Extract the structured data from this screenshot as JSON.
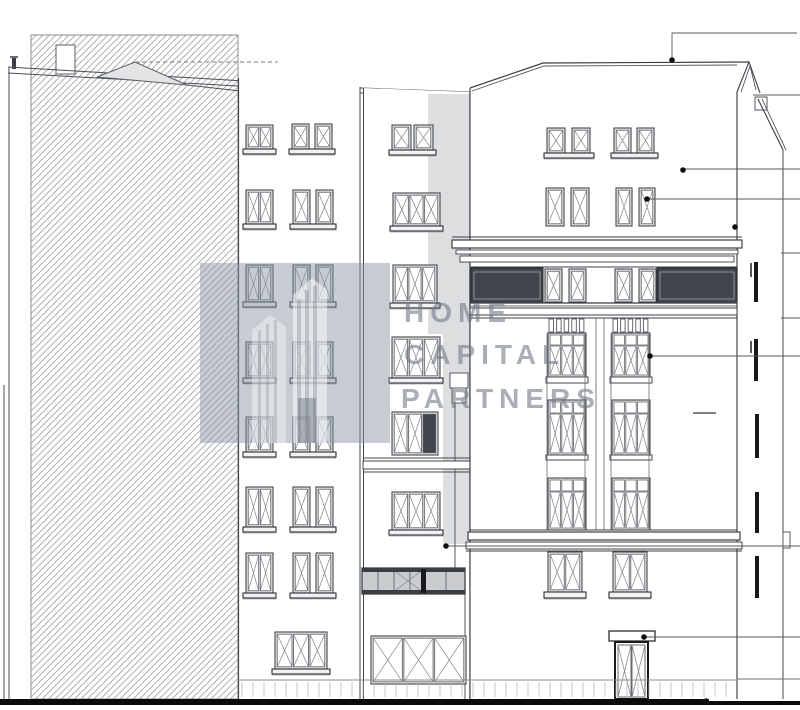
{
  "watermark": {
    "logo_icon": "building-towers-icon",
    "lines": [
      "HOME",
      "CAPITAL",
      "PARTNERS"
    ]
  },
  "colors": {
    "line": "#3b3f44",
    "heavy_line": "#17191c",
    "ground": "#0b0b0b",
    "hatch": "#9aa0a8",
    "shadow": "#dcdee0",
    "window_frame": "#e6e7e8",
    "dark_glazing": "#41464d",
    "watermark_box": "#8894a0",
    "watermark_text": "#737b87"
  }
}
